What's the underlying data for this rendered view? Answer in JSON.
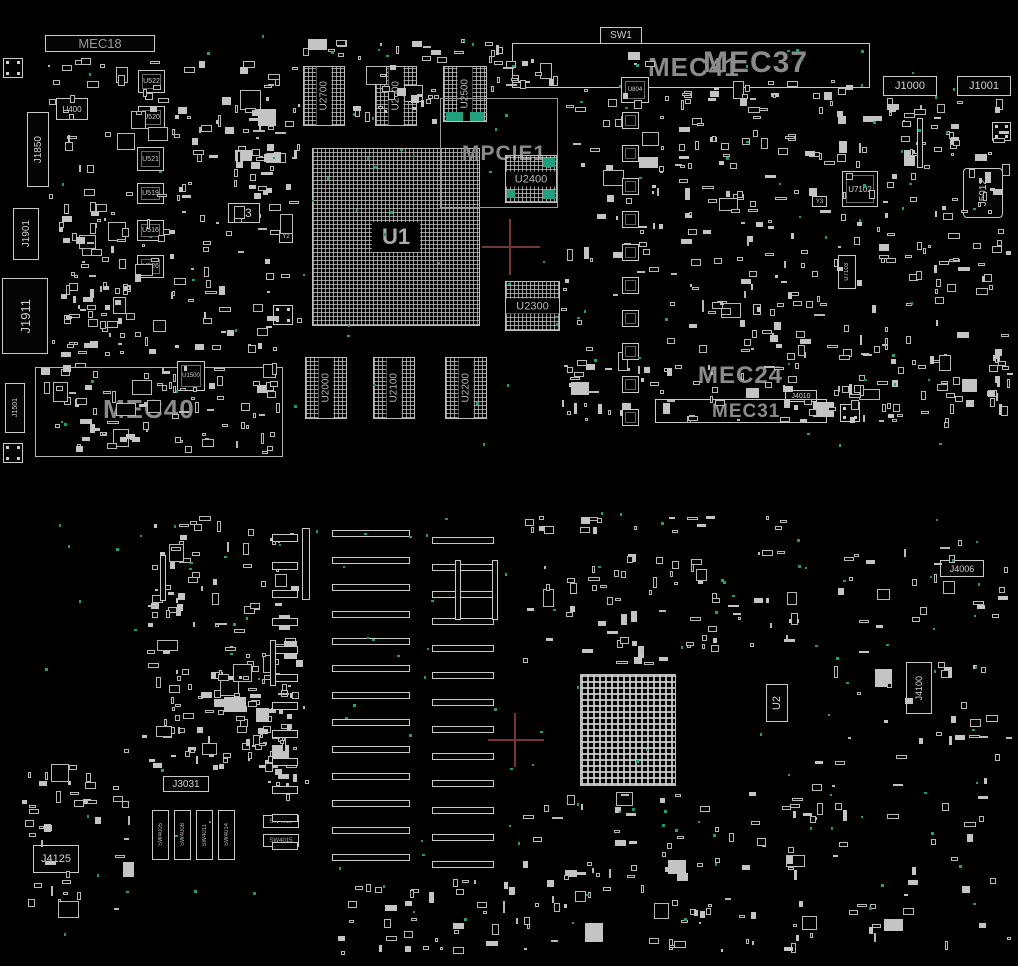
{
  "app": {
    "type": "pcb-assembly-board-view",
    "side_note": "top and bottom board silkscreen views"
  },
  "colors": {
    "background": "#000000",
    "outline": "#c9c9c9",
    "banner_text": "#8b8b8b",
    "ref_text": "#cfcfcf",
    "highlight_teal": "#1ea17c",
    "test_point_green": "#1d9a63",
    "crosshair_red": "#7a3434"
  },
  "c": {
    "mec18": "MEC18",
    "mec40": "MEC40",
    "mec41": "MEC41",
    "mec37": "MEC37",
    "mec24": "MEC24",
    "mec31": "MEC31",
    "mpcie1": "MPCIE1",
    "sw1": "SW1",
    "j1850": "J1850",
    "j1901": "J1901",
    "j1911": "J1911",
    "j1501": "J1501",
    "j1000": "J1000",
    "j1001": "J1001",
    "j5012": "J5012",
    "j4010": "J4010",
    "u400": "U400",
    "u522": "U522",
    "u520": "U520",
    "u521": "U521",
    "u519": "U519",
    "u516": "U516",
    "u526": "U526",
    "u3": "U3",
    "y2": "Y2",
    "y3": "Y3",
    "u1": "U1",
    "u804": "U804",
    "u1500": "U1500",
    "u7102": "U7102",
    "u7103": "U7103",
    "u2000": "U2000",
    "u2100": "U2100",
    "u2200": "U2200",
    "u2300": "U2300",
    "u2400": "U2400",
    "u2500": "U2500",
    "u2600": "U2600",
    "u2700": "U2700",
    "j4006": "J4006",
    "j4100": "J4100",
    "j4125": "J4125",
    "j3031": "J3031",
    "u2": "U2",
    "sw4005": "SW4005",
    "sw4008": "SW4008",
    "sw4011": "SW4011",
    "sw4014": "SW4014",
    "sw4010": "SW4010",
    "sw4015": "SW4015"
  }
}
